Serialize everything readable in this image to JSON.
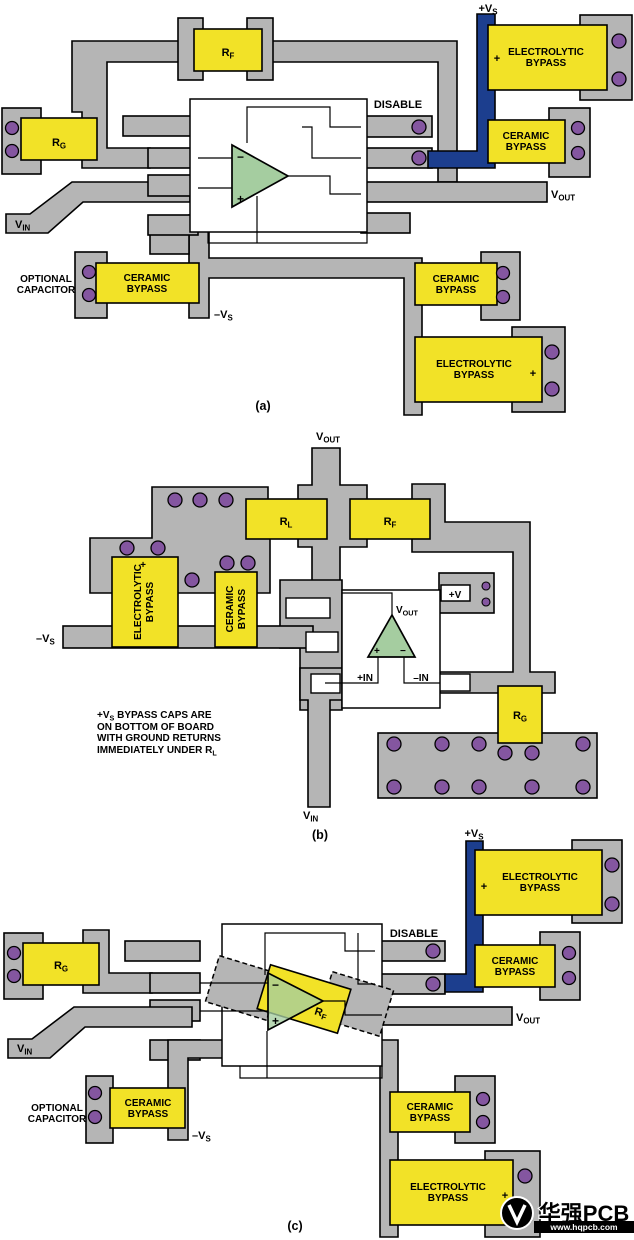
{
  "colors": {
    "copper_gray": "#b5b5b5",
    "component_yellow": "#f2e227",
    "power_blue": "#1c3e8e",
    "via_purple": "#8456a0",
    "opamp_green": "#a5cda0",
    "outline_black": "#000000",
    "background": "#ffffff"
  },
  "labels": {
    "disable": "DISABLE",
    "optional_line1": "OPTIONAL",
    "optional_line2": "CAPACITOR",
    "ceramic_line1": "CERAMIC",
    "ceramic_line2": "BYPASS",
    "electrolytic_line1": "ELECTROLYTIC",
    "electrolytic_line2": "BYPASS",
    "plus": "+",
    "minus": "−",
    "plus_v": "+V",
    "plus_in": "+IN",
    "minus_in": "–IN"
  },
  "refs": {
    "plus_vs": [
      {
        "t": "+V"
      },
      {
        "t": "S",
        "sub": true
      }
    ],
    "minus_vs": [
      {
        "t": "–V"
      },
      {
        "t": "S",
        "sub": true
      }
    ],
    "vin": [
      {
        "t": "V"
      },
      {
        "t": "IN",
        "sub": true
      }
    ],
    "vout": [
      {
        "t": "V"
      },
      {
        "t": "OUT",
        "sub": true
      }
    ],
    "rf": [
      {
        "t": "R"
      },
      {
        "t": "F",
        "sub": true
      }
    ],
    "rg": [
      {
        "t": "R"
      },
      {
        "t": "G",
        "sub": true
      }
    ],
    "rl": [
      {
        "t": "R"
      },
      {
        "t": "L",
        "sub": true
      }
    ]
  },
  "panels": {
    "a": {
      "caption": "(a)"
    },
    "b": {
      "caption": "(b)",
      "note_lines": [
        [
          {
            "t": "+V"
          },
          {
            "t": "S",
            "sub": true
          },
          {
            "t": " BYPASS CAPS ARE"
          }
        ],
        [
          {
            "t": "ON BOTTOM OF BOARD"
          }
        ],
        [
          {
            "t": "WITH GROUND RETURNS"
          }
        ],
        [
          {
            "t": "IMMEDIATELY UNDER R"
          },
          {
            "t": "L",
            "sub": true
          }
        ]
      ]
    },
    "c": {
      "caption": "(c)"
    }
  },
  "watermark": {
    "brand": "华强PCB",
    "url": "www.hqpcb.com"
  }
}
